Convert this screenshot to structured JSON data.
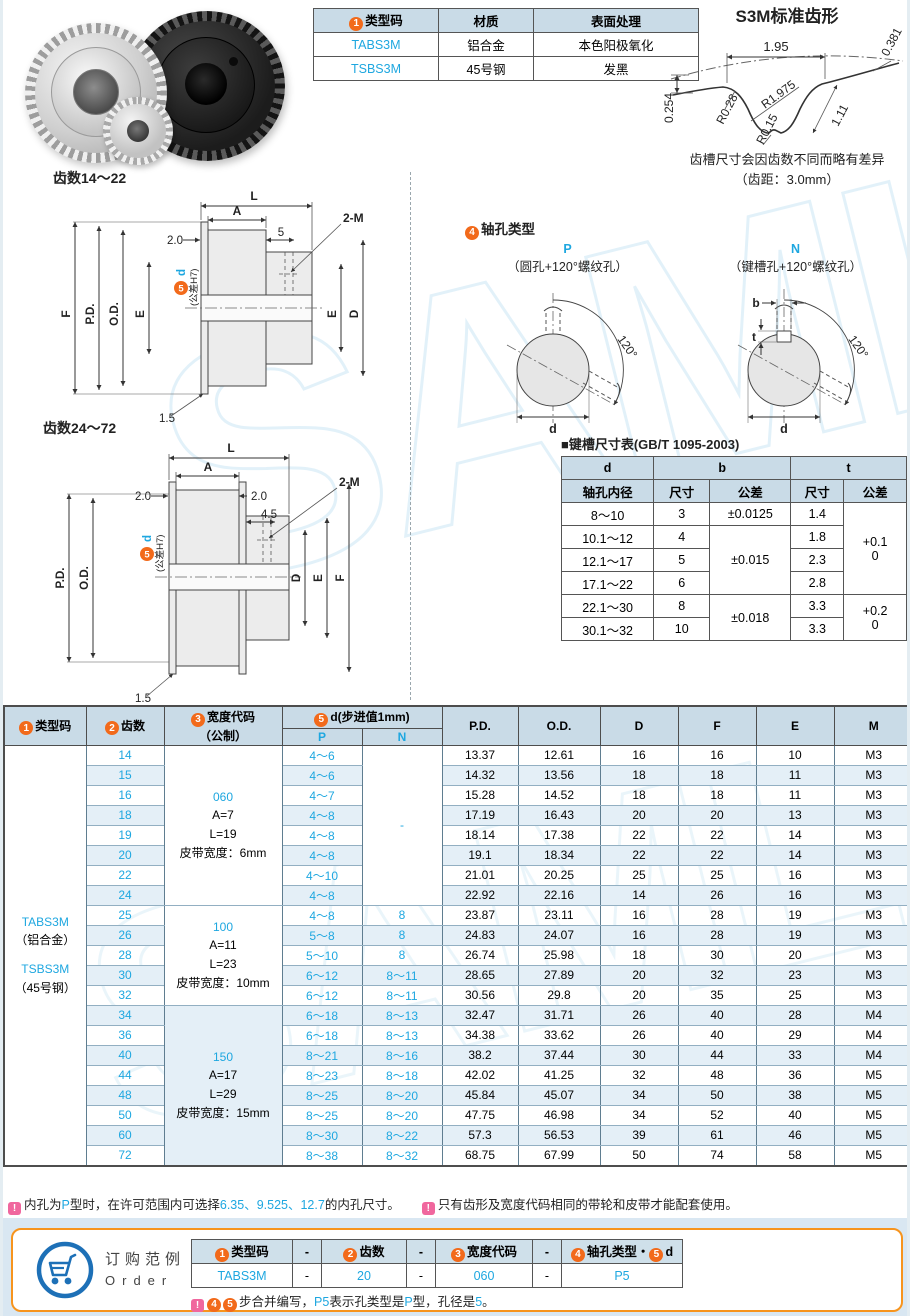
{
  "watermark": {
    "text": "SAML"
  },
  "spec_table": {
    "headers": [
      {
        "num": "1",
        "t": "类型码"
      },
      {
        "t": "材质"
      },
      {
        "t": "表面处理"
      }
    ],
    "rows": [
      [
        {
          "t": "TABS3M",
          "b": 1
        },
        {
          "t": "铝合金"
        },
        {
          "t": "本色阳极氧化"
        }
      ],
      [
        {
          "t": "TSBS3M",
          "b": 1
        },
        {
          "t": "45号钢"
        },
        {
          "t": "发黑"
        }
      ]
    ]
  },
  "tooth_profile": {
    "title": "S3M标准齿形",
    "dim_pitch": "1.95",
    "dim_r_top": "0.381",
    "dim_left": "0.254",
    "dim_depth": "1.11",
    "r1": "R0.28",
    "r2": "R1.975",
    "r3": "R0.15",
    "note1": "齿槽尺寸会因齿数不同而略有差异",
    "note2": "（齿距：3.0mm）"
  },
  "drawing_small": {
    "title": "齿数14～22",
    "L": "L",
    "A": "A",
    "d20": "2.0",
    "d5": "5",
    "m": "2-M",
    "dnum": "5",
    "dlabel": "d",
    "dtol": "(公差H7)",
    "F": "F",
    "PD": "P.D.",
    "OD": "O.D.",
    "E": "E",
    "E2": "E",
    "D": "D",
    "d15": "1.5"
  },
  "drawing_big": {
    "title": "齿数24～72",
    "L": "L",
    "A": "A",
    "d20l": "2.0",
    "d20r": "2.0",
    "d45": "4.5",
    "m": "2-M",
    "dnum": "5",
    "dlabel": "d",
    "dtol": "(公差H7)",
    "PD": "P.D.",
    "OD": "O.D.",
    "D": "D",
    "E": "E",
    "F": "F",
    "d15": "1.5"
  },
  "shaft": {
    "num": "4",
    "title": "轴孔类型",
    "p": "P",
    "p_desc": "（圆孔+120°螺纹孔）",
    "n": "N",
    "n_desc": "（键槽孔+120°螺纹孔）",
    "angle_p": "120°",
    "angle_n": "120°",
    "d_p": "d",
    "d_n": "d",
    "b": "b",
    "t": "t"
  },
  "keyway": {
    "title": "■键槽尺寸表(GB/T 1095-2003)",
    "h_d": "d",
    "h_d2": "轴孔内径",
    "h_b": "b",
    "h_t": "t",
    "h_size1": "尺寸",
    "h_tol1": "公差",
    "h_size2": "尺寸",
    "h_tol2": "公差",
    "rows": [
      [
        {
          "t": "8～10"
        },
        {
          "t": "3"
        },
        {
          "t": "±0.0125"
        },
        {
          "t": "1.4"
        },
        {
          "t": "+0.1\n0",
          "rs": 4
        }
      ],
      [
        {
          "t": "10.1～12"
        },
        {
          "t": "4"
        },
        {
          "t": "±0.015",
          "rs": 3
        },
        {
          "t": "1.8"
        }
      ],
      [
        {
          "t": "12.1～17"
        },
        {
          "t": "5"
        },
        {
          "t": "2.3"
        }
      ],
      [
        {
          "t": "17.1～22"
        },
        {
          "t": "6"
        },
        {
          "t": "2.8"
        }
      ],
      [
        {
          "t": "22.1～30"
        },
        {
          "t": "8"
        },
        {
          "t": "±0.018",
          "rs": 2
        },
        {
          "t": "3.3"
        },
        {
          "t": "+0.2\n0",
          "rs": 2
        }
      ],
      [
        {
          "t": "30.1～32"
        },
        {
          "t": "10"
        },
        {
          "t": "3.3"
        }
      ]
    ]
  },
  "main_table": {
    "h_type": {
      "num": "1",
      "t": "类型码"
    },
    "h_teeth": {
      "num": "2",
      "t": "齿数"
    },
    "h_width": {
      "num": "3",
      "t": "宽度代码"
    },
    "h_width2": "（公制）",
    "h_d": {
      "num": "5",
      "t": "d(步进值1mm)"
    },
    "h_p": "P",
    "h_n": "N",
    "h_cols": [
      "P.D.",
      "O.D.",
      "D",
      "F",
      "E",
      "M"
    ],
    "type_lines": [
      {
        "t": "TABS3M",
        "b": 1
      },
      {
        "t": "（铝合金）"
      },
      {
        "t": " "
      },
      {
        "t": "TSBS3M",
        "b": 1
      },
      {
        "t": "（45号钢）"
      }
    ],
    "n_dash": "-",
    "width_groups": [
      {
        "start": 0,
        "span": 8,
        "lines": [
          {
            "t": "060",
            "b": 1
          },
          {
            "t": "A=7"
          },
          {
            "t": "L=19"
          },
          {
            "t": "皮带宽度：6mm"
          }
        ]
      },
      {
        "start": 8,
        "span": 5,
        "lines": [
          {
            "t": "100",
            "b": 1
          },
          {
            "t": "A=11"
          },
          {
            "t": "L=23"
          },
          {
            "t": "皮带宽度：10mm"
          }
        ]
      },
      {
        "start": 13,
        "span": 8,
        "lines": [
          {
            "t": "150",
            "b": 1
          },
          {
            "t": "A=17"
          },
          {
            "t": "L=29"
          },
          {
            "t": "皮带宽度：15mm"
          }
        ]
      }
    ],
    "rows": [
      [
        "14",
        "4～6",
        "",
        "13.37",
        "12.61",
        "16",
        "16",
        "10",
        "M3"
      ],
      [
        "15",
        "4～6",
        "",
        "14.32",
        "13.56",
        "18",
        "18",
        "11",
        "M3"
      ],
      [
        "16",
        "4～7",
        "",
        "15.28",
        "14.52",
        "18",
        "18",
        "11",
        "M3"
      ],
      [
        "18",
        "4～8",
        "",
        "17.19",
        "16.43",
        "20",
        "20",
        "13",
        "M3"
      ],
      [
        "19",
        "4～8",
        "",
        "18.14",
        "17.38",
        "22",
        "22",
        "14",
        "M3"
      ],
      [
        "20",
        "4～8",
        "",
        "19.1",
        "18.34",
        "22",
        "22",
        "14",
        "M3"
      ],
      [
        "22",
        "4～10",
        "",
        "21.01",
        "20.25",
        "25",
        "25",
        "16",
        "M3"
      ],
      [
        "24",
        "4～8",
        "",
        "22.92",
        "22.16",
        "14",
        "26",
        "16",
        "M3"
      ],
      [
        "25",
        "4～8",
        "8",
        "23.87",
        "23.11",
        "16",
        "28",
        "19",
        "M3"
      ],
      [
        "26",
        "5～8",
        "8",
        "24.83",
        "24.07",
        "16",
        "28",
        "19",
        "M3"
      ],
      [
        "28",
        "5～10",
        "8",
        "26.74",
        "25.98",
        "18",
        "30",
        "20",
        "M3"
      ],
      [
        "30",
        "6～12",
        "8～11",
        "28.65",
        "27.89",
        "20",
        "32",
        "23",
        "M3"
      ],
      [
        "32",
        "6～12",
        "8～11",
        "30.56",
        "29.8",
        "20",
        "35",
        "25",
        "M3"
      ],
      [
        "34",
        "6～18",
        "8～13",
        "32.47",
        "31.71",
        "26",
        "40",
        "28",
        "M4"
      ],
      [
        "36",
        "6～18",
        "8～13",
        "34.38",
        "33.62",
        "26",
        "40",
        "29",
        "M4"
      ],
      [
        "40",
        "8～21",
        "8～16",
        "38.2",
        "37.44",
        "30",
        "44",
        "33",
        "M4"
      ],
      [
        "44",
        "8～23",
        "8～18",
        "42.02",
        "41.25",
        "32",
        "48",
        "36",
        "M5"
      ],
      [
        "48",
        "8～25",
        "8～20",
        "45.84",
        "45.07",
        "34",
        "50",
        "38",
        "M5"
      ],
      [
        "50",
        "8～25",
        "8～20",
        "47.75",
        "46.98",
        "34",
        "52",
        "40",
        "M5"
      ],
      [
        "60",
        "8～30",
        "8～22",
        "57.3",
        "56.53",
        "39",
        "61",
        "46",
        "M5"
      ],
      [
        "72",
        "8～38",
        "8～32",
        "68.75",
        "67.99",
        "50",
        "74",
        "58",
        "M5"
      ]
    ]
  },
  "notes": {
    "n1": [
      {
        "ex": 1
      },
      {
        "t": "内孔为"
      },
      {
        "t": "P",
        "b": 1
      },
      {
        "t": "型时，在许可范围内可选择"
      },
      {
        "t": "6.35、9.525、12.7",
        "b": 1
      },
      {
        "t": "的内孔尺寸。"
      }
    ],
    "n2": [
      {
        "ex": 1
      },
      {
        "t": "只有齿形及宽度代码相同的带轮和皮带才能配套使用。"
      }
    ]
  },
  "order": {
    "title_cn": "订购范例",
    "title_en": "Order",
    "headers": [
      {
        "segs": [
          {
            "num": "1"
          },
          {
            "t": "类型码"
          }
        ]
      },
      {
        "segs": [
          {
            "t": "-"
          }
        ]
      },
      {
        "segs": [
          {
            "num": "2"
          },
          {
            "t": "齿数"
          }
        ]
      },
      {
        "segs": [
          {
            "t": "-"
          }
        ]
      },
      {
        "segs": [
          {
            "num": "3"
          },
          {
            "t": "宽度代码"
          }
        ]
      },
      {
        "segs": [
          {
            "t": "-"
          }
        ]
      },
      {
        "segs": [
          {
            "num": "4"
          },
          {
            "t": "轴孔类型・"
          },
          {
            "num": "5"
          },
          {
            "t": "d"
          }
        ]
      }
    ],
    "values": [
      {
        "t": "TABS3M",
        "b": 1
      },
      {
        "t": "-"
      },
      {
        "t": "20",
        "b": 1
      },
      {
        "t": "-"
      },
      {
        "t": "060",
        "b": 1
      },
      {
        "t": "-"
      },
      {
        "t": "P5",
        "b": 1
      }
    ],
    "note": [
      {
        "ex": 1
      },
      {
        "num": "4"
      },
      {
        "num": "5"
      },
      {
        "t": "步合并编写，"
      },
      {
        "t": "P5",
        "b": 1
      },
      {
        "t": "表示孔类型是"
      },
      {
        "t": "P",
        "b": 1
      },
      {
        "t": "型，孔径是"
      },
      {
        "t": "5",
        "b": 1
      },
      {
        "t": "。"
      }
    ]
  }
}
